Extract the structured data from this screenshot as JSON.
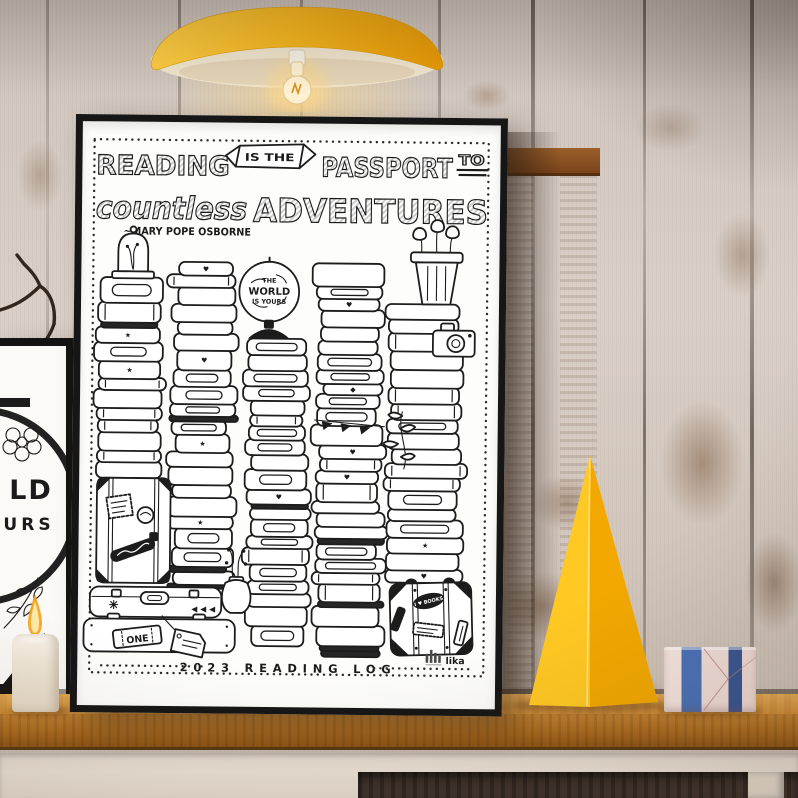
{
  "poster": {
    "title": {
      "reading": "READING",
      "banner": "IS THE",
      "passport": "PASSPORT",
      "to": "TO",
      "countless": "countless",
      "adventures": "ADVENTURES"
    },
    "attribution": "~MARY POPE OSBORNE",
    "globe": {
      "l1": "THE",
      "l2": "WORLD",
      "l3": "IS YOURS"
    },
    "footer": "2023 READING LOG",
    "logo": "lika",
    "stickers": {
      "ticket": "ONE",
      "heart": "I ♥ BOOKS"
    },
    "illustration": {
      "spine_glyphs": [
        "♥",
        "◆",
        "★"
      ],
      "stacks": [
        {
          "id": "A",
          "x": 49,
          "w": 62,
          "top": 156,
          "bottom": 357,
          "seed": 11
        },
        {
          "id": "B",
          "x": 123,
          "w": 60,
          "top": 140,
          "bottom": 467,
          "seed": 23
        },
        {
          "id": "C",
          "x": 199,
          "w": 58,
          "top": 216,
          "bottom": 524,
          "seed": 37
        },
        {
          "id": "D",
          "x": 271,
          "w": 64,
          "top": 140,
          "bottom": 534,
          "seed": 53
        },
        {
          "id": "E",
          "x": 346,
          "w": 74,
          "top": 180,
          "bottom": 459,
          "seed": 71
        }
      ]
    }
  },
  "left_print": {
    "l1": "LD",
    "l2": "URS"
  },
  "colors": {
    "lamp_yellow": "#F6AE12",
    "cone_yellow": "#FFC114",
    "shelf_wood": "#C9852E",
    "wall": "#D6CCC4",
    "frame_black": "#161616",
    "ribbon_blue": "#4A71B5",
    "ribbon_navy": "#3A5590",
    "gift_pink": "#EFDCD6",
    "ink": "#1C1C1C"
  }
}
